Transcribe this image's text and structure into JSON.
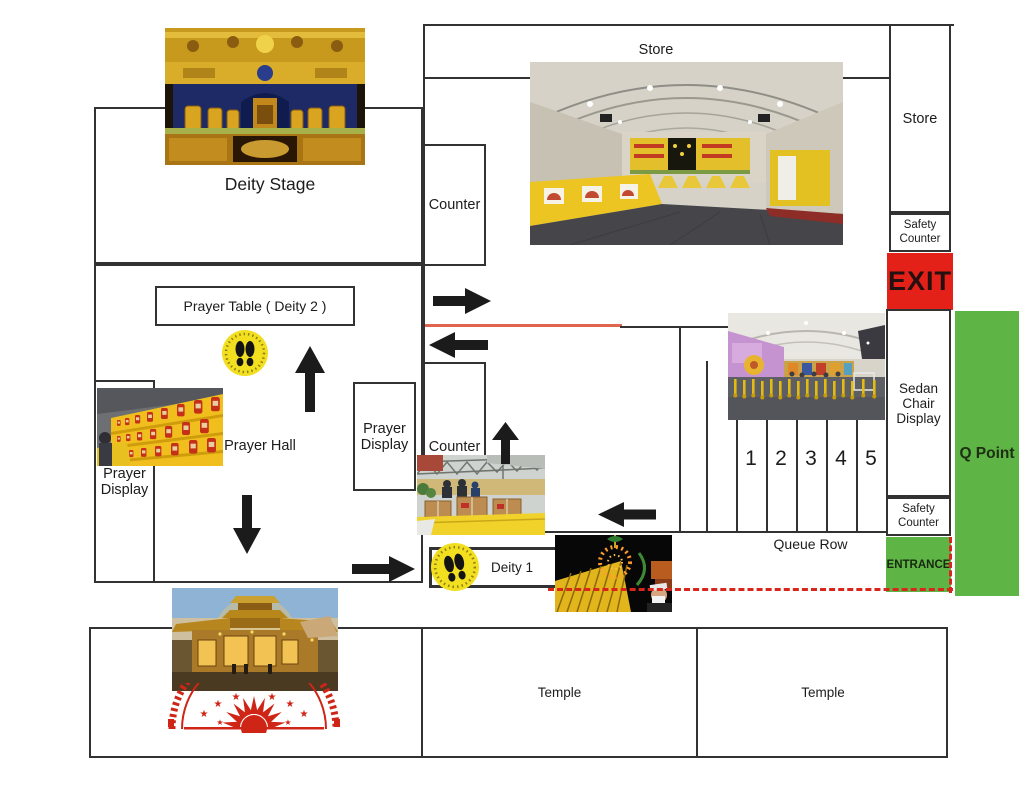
{
  "map": {
    "labels": {
      "deity_stage": "Deity Stage",
      "store_top": "Store",
      "store_right": "Store",
      "counter_top": "Counter",
      "counter_mid": "Counter",
      "prayer_table_deity2": "Prayer Table ( Deity 2 )",
      "prayer_hall": "Prayer Hall",
      "prayer_display_left": "Prayer Display",
      "prayer_display_mid": "Prayer Display",
      "safety_counter_top": "Safety Counter",
      "safety_counter_bottom": "Safety Counter",
      "exit": "EXIT",
      "sedan_chair_display": "Sedan Chair Display",
      "q_point": "Q Point",
      "entrance": "ENTRANCE",
      "deity_1": "Deity 1",
      "queue_row": "Queue Row",
      "temple_left": "Temple",
      "temple_right": "Temple"
    },
    "queue_lanes": [
      "1",
      "2",
      "3",
      "4",
      "5"
    ],
    "colors": {
      "exit_red": "#e32119",
      "entrance_green": "#5eb445",
      "qpoint_green": "#5eb445",
      "route_red_line": "#e0654e",
      "barrier_red_dash": "#d9261c",
      "footprint_sticker_yellow": "#f2df20",
      "wall": "#323232"
    },
    "icons": {
      "footprints_sticker": "two black footprints on yellow circle",
      "flow_arrows": "black direction arrows (up, down, left, right)"
    }
  }
}
